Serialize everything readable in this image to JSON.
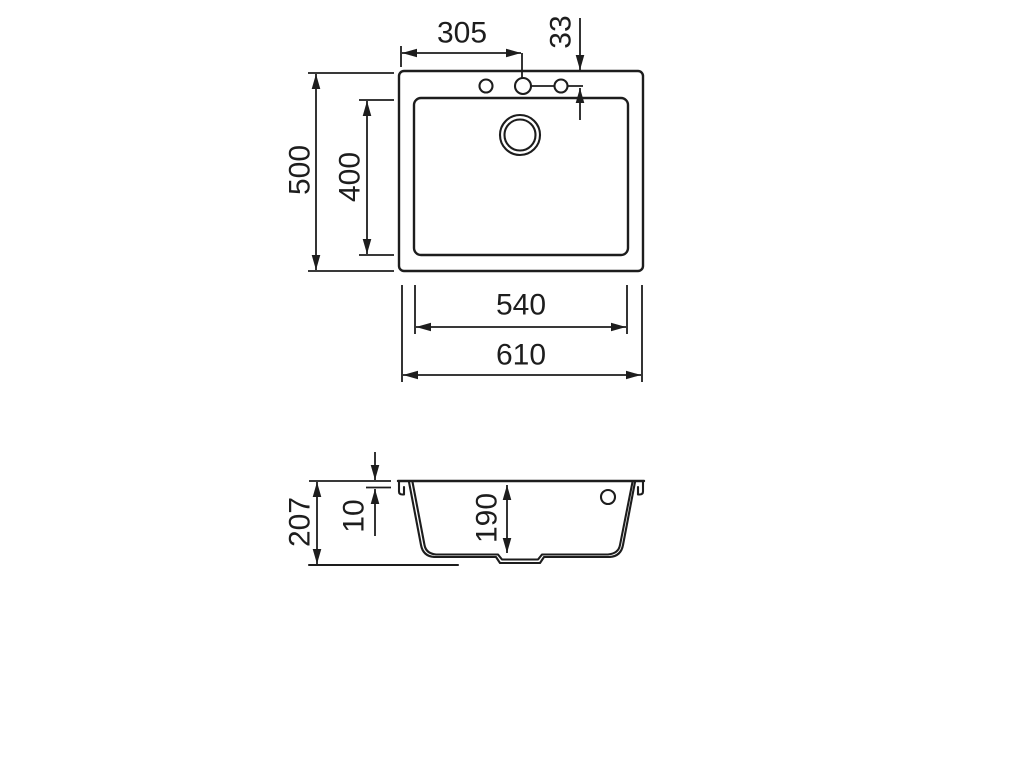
{
  "drawing": {
    "kind": "sink-technical-dimension-drawing",
    "top_view": {
      "dims": {
        "tap_hole_x": "305",
        "tap_hole_y": "33",
        "outer_depth": "500",
        "bowl_depth": "400",
        "bowl_width": "540",
        "outer_width": "610"
      }
    },
    "section_view": {
      "dims": {
        "total_height": "207",
        "rim_height": "10",
        "bowl_depth": "190"
      }
    }
  }
}
